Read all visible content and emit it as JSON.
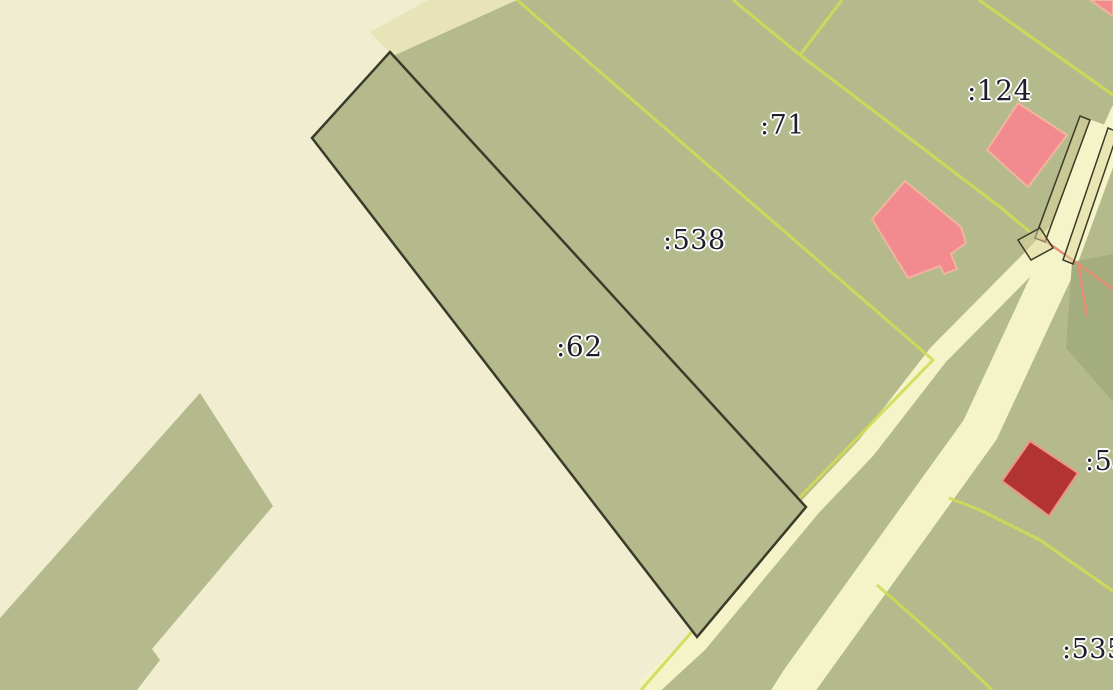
{
  "map": {
    "kind": "cadastral-parcel-map",
    "parcels": [
      {
        "id": "62",
        "label": ":62",
        "selected": true
      },
      {
        "id": "538",
        "label": ":538",
        "selected": false
      },
      {
        "id": "71",
        "label": ":71",
        "selected": false
      },
      {
        "id": "124",
        "label": ":124",
        "selected": false
      },
      {
        "id": "53",
        "label": ":53",
        "selected": false
      },
      {
        "id": "535",
        "label": ":535",
        "selected": false
      }
    ],
    "colors": {
      "bg": "#f0edd0",
      "green": "#b5ba8c",
      "green_dark": "#a4ad7d",
      "road": "#f5f4c8",
      "road_dark": "#e7e4b8",
      "boundary_yellow": "#cedd56",
      "outline_dark": "#3b3b29",
      "building_pink": "#f28b90",
      "building_pink_stroke": "#f1b59c",
      "building_red": "#b23430",
      "building_red_stroke": "#ea9683",
      "line_salmon": "#e78d74",
      "label": "#1f1f2b"
    }
  }
}
